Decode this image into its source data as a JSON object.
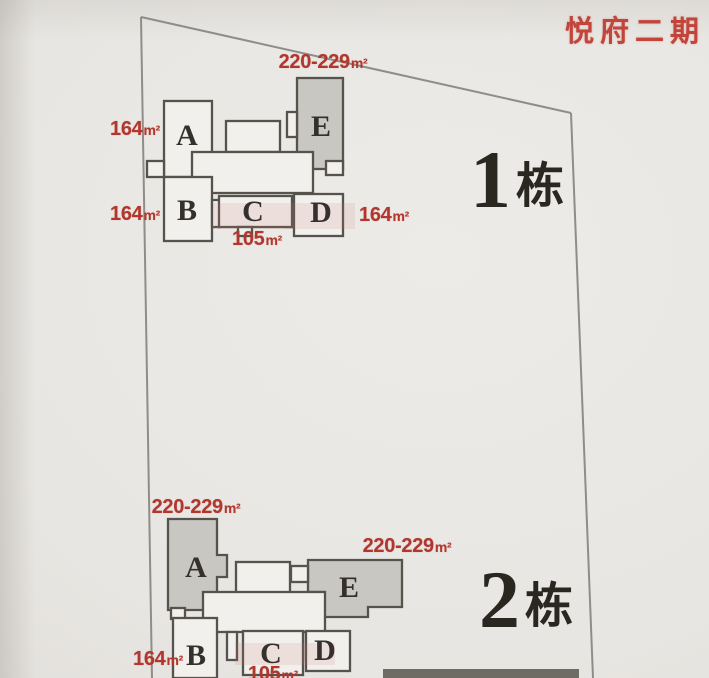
{
  "title": "悦府二期",
  "colors": {
    "paper": "#e8e6e2",
    "red_text": "#b1362d",
    "plan_stroke": "#56534d",
    "unit_fill": "#f1f0ed",
    "unit_shaded_fill": "#c9c7c1",
    "boundary_line": "#8f8d89",
    "building_name_ink": "#29271f"
  },
  "buildings": [
    {
      "label_num": "1",
      "label_suffix": "栋",
      "units": [
        "A",
        "B",
        "C",
        "D",
        "E"
      ],
      "shaded_units": [
        "E"
      ],
      "area_labels": [
        {
          "value": "220-229",
          "unit": "m²",
          "for_unit": "E"
        },
        {
          "value": "164",
          "unit": "m²",
          "for_unit": "A"
        },
        {
          "value": "164",
          "unit": "m²",
          "for_unit": "B"
        },
        {
          "value": "164",
          "unit": "m²",
          "for_unit": "D"
        },
        {
          "value": "105",
          "unit": "m²",
          "for_unit": "C"
        }
      ]
    },
    {
      "label_num": "2",
      "label_suffix": "栋",
      "units": [
        "A",
        "B",
        "C",
        "D",
        "E"
      ],
      "shaded_units": [
        "A",
        "E"
      ],
      "area_labels": [
        {
          "value": "220-229",
          "unit": "m²",
          "for_unit": "A"
        },
        {
          "value": "220-229",
          "unit": "m²",
          "for_unit": "E"
        },
        {
          "value": "164",
          "unit": "m²",
          "for_unit": "B"
        },
        {
          "value": "105",
          "unit": "m²",
          "for_unit": "C"
        }
      ]
    }
  ]
}
